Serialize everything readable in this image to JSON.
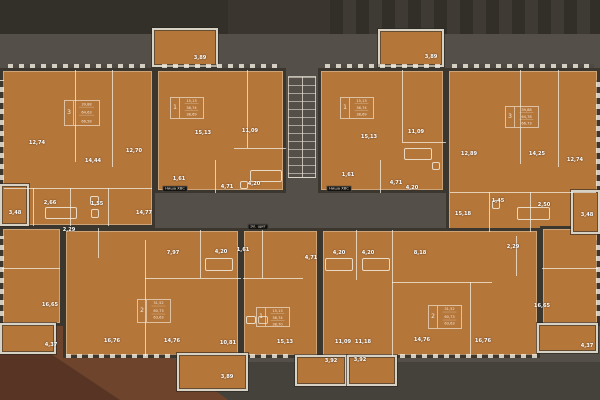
{
  "colors": {
    "apartment_fill": "#b5763a",
    "wall_dark": "#3b372f",
    "interior_line": "#f8f2e6",
    "background": "#544f48",
    "background_top": "#37332d",
    "background_bottom": "#45423c",
    "rust_triangle": "#6e452c",
    "rust_triangle_dark": "#573423",
    "balcony_frame": "#d8d2c4",
    "label_text": "#ffffff",
    "badge_bg": "#14120f"
  },
  "plan": {
    "apartments": [
      {
        "id": "top-left-outer",
        "x": 0,
        "y": 68,
        "w": 155,
        "h": 160
      },
      {
        "id": "top-left-inner",
        "x": 155,
        "y": 68,
        "w": 131,
        "h": 125
      },
      {
        "id": "top-right-inner",
        "x": 318,
        "y": 68,
        "w": 128,
        "h": 125
      },
      {
        "id": "top-right-outer",
        "x": 446,
        "y": 68,
        "w": 154,
        "h": 165
      },
      {
        "id": "bottom-left-outer",
        "x": 0,
        "y": 226,
        "w": 63,
        "h": 100
      },
      {
        "id": "bottom-left-inner",
        "x": 63,
        "y": 228,
        "w": 178,
        "h": 130
      },
      {
        "id": "bottom-center",
        "x": 241,
        "y": 228,
        "w": 79,
        "h": 130
      },
      {
        "id": "bottom-right-inner",
        "x": 320,
        "y": 228,
        "w": 220,
        "h": 130
      },
      {
        "id": "bottom-right-outer",
        "x": 540,
        "y": 226,
        "w": 60,
        "h": 100
      }
    ],
    "balconies": [
      {
        "id": "top-left-balcony",
        "x": 152,
        "y": 28,
        "w": 66,
        "h": 39
      },
      {
        "id": "top-right-balcony",
        "x": 378,
        "y": 29,
        "w": 66,
        "h": 38
      },
      {
        "id": "bottom-left-balcony",
        "x": 177,
        "y": 353,
        "w": 71,
        "h": 38
      },
      {
        "id": "bottom-center-balcony-1",
        "x": 295,
        "y": 355,
        "w": 52,
        "h": 31
      },
      {
        "id": "bottom-center-balcony-2",
        "x": 347,
        "y": 355,
        "w": 50,
        "h": 31
      },
      {
        "id": "left-side-balcony",
        "x": 0,
        "y": 323,
        "w": 56,
        "h": 31
      },
      {
        "id": "right-side-balcony",
        "x": 537,
        "y": 323,
        "w": 61,
        "h": 30
      },
      {
        "id": "left-loggia",
        "x": 0,
        "y": 184,
        "w": 29,
        "h": 42
      },
      {
        "id": "right-loggia",
        "x": 571,
        "y": 190,
        "w": 29,
        "h": 44
      }
    ],
    "rooms": [
      {
        "label": "12,74",
        "x": 37,
        "y": 143
      },
      {
        "label": "14,44",
        "x": 93,
        "y": 161
      },
      {
        "label": "12,70",
        "x": 134,
        "y": 151
      },
      {
        "label": "3,48",
        "x": 15,
        "y": 213
      },
      {
        "label": "2,66",
        "x": 50,
        "y": 203
      },
      {
        "label": "1,55",
        "x": 97,
        "y": 204
      },
      {
        "label": "14,77",
        "x": 144,
        "y": 213
      },
      {
        "label": "15,13",
        "x": 203,
        "y": 133
      },
      {
        "label": "11,09",
        "x": 250,
        "y": 131
      },
      {
        "label": "1,61",
        "x": 179,
        "y": 179
      },
      {
        "label": "4,71",
        "x": 227,
        "y": 187
      },
      {
        "label": "4,20",
        "x": 254,
        "y": 184
      },
      {
        "label": "15,13",
        "x": 369,
        "y": 137
      },
      {
        "label": "11,09",
        "x": 416,
        "y": 132
      },
      {
        "label": "1,61",
        "x": 348,
        "y": 175
      },
      {
        "label": "4,71",
        "x": 396,
        "y": 183
      },
      {
        "label": "4,20",
        "x": 412,
        "y": 188
      },
      {
        "label": "12,89",
        "x": 469,
        "y": 154
      },
      {
        "label": "14,25",
        "x": 537,
        "y": 154
      },
      {
        "label": "12,74",
        "x": 575,
        "y": 160
      },
      {
        "label": "15,18",
        "x": 463,
        "y": 214
      },
      {
        "label": "1,45",
        "x": 498,
        "y": 201
      },
      {
        "label": "2,50",
        "x": 544,
        "y": 205
      },
      {
        "label": "3,48",
        "x": 587,
        "y": 215
      },
      {
        "label": "16,65",
        "x": 50,
        "y": 305
      },
      {
        "label": "2,29",
        "x": 69,
        "y": 230
      },
      {
        "label": "7,97",
        "x": 173,
        "y": 253
      },
      {
        "label": "4,20",
        "x": 221,
        "y": 252
      },
      {
        "label": "16,76",
        "x": 112,
        "y": 341
      },
      {
        "label": "14,76",
        "x": 172,
        "y": 341
      },
      {
        "label": "10,81",
        "x": 228,
        "y": 343
      },
      {
        "label": "1,61",
        "x": 243,
        "y": 250
      },
      {
        "label": "4,71",
        "x": 311,
        "y": 258
      },
      {
        "label": "15,13",
        "x": 285,
        "y": 342
      },
      {
        "label": "4,20",
        "x": 339,
        "y": 253
      },
      {
        "label": "4,20",
        "x": 368,
        "y": 253
      },
      {
        "label": "8,18",
        "x": 420,
        "y": 253
      },
      {
        "label": "2,29",
        "x": 513,
        "y": 247
      },
      {
        "label": "11,09",
        "x": 343,
        "y": 342
      },
      {
        "label": "11,18",
        "x": 363,
        "y": 342
      },
      {
        "label": "14,76",
        "x": 422,
        "y": 340
      },
      {
        "label": "16,76",
        "x": 483,
        "y": 341
      },
      {
        "label": "16,65",
        "x": 542,
        "y": 306
      },
      {
        "label": "4,37",
        "x": 587,
        "y": 346
      },
      {
        "label": "4,37",
        "x": 51,
        "y": 345
      },
      {
        "label": "3,89",
        "x": 200,
        "y": 58
      },
      {
        "label": "3,89",
        "x": 431,
        "y": 57
      },
      {
        "label": "3,89",
        "x": 227,
        "y": 377
      },
      {
        "label": "3,92",
        "x": 331,
        "y": 361
      },
      {
        "label": "3,92",
        "x": 360,
        "y": 360
      }
    ],
    "stamps": [
      {
        "x": 64,
        "y": 100,
        "w": 36,
        "h": 26,
        "count": "3",
        "lines": [
          "39,88",
          "64,63",
          "66,58"
        ]
      },
      {
        "x": 170,
        "y": 97,
        "w": 34,
        "h": 22,
        "count": "1",
        "lines": [
          "15,13",
          "36,74",
          "38,69"
        ]
      },
      {
        "x": 340,
        "y": 97,
        "w": 34,
        "h": 22,
        "count": "1",
        "lines": [
          "15,13",
          "36,74",
          "38,69"
        ]
      },
      {
        "x": 505,
        "y": 106,
        "w": 34,
        "h": 22,
        "count": "3",
        "lines": [
          "39,88",
          "64,78",
          "66,73"
        ]
      },
      {
        "x": 137,
        "y": 299,
        "w": 34,
        "h": 24,
        "count": "2",
        "lines": [
          "31,52",
          "60,73",
          "63,63"
        ]
      },
      {
        "x": 256,
        "y": 307,
        "w": 34,
        "h": 20,
        "count": "1",
        "lines": [
          "15,13",
          "36,74",
          "38,70"
        ]
      },
      {
        "x": 428,
        "y": 305,
        "w": 34,
        "h": 24,
        "count": "2",
        "lines": [
          "31,52",
          "60,73",
          "63,63"
        ]
      }
    ],
    "badges": [
      {
        "label": "Ниша ХВС",
        "x": 175,
        "y": 189
      },
      {
        "label": "Ниша ХВС",
        "x": 339,
        "y": 189
      },
      {
        "label": "Эл. щит",
        "x": 258,
        "y": 227
      }
    ],
    "partitions": [
      {
        "x": 75,
        "y": 70,
        "w": 1,
        "h": 92
      },
      {
        "x": 112,
        "y": 70,
        "w": 1,
        "h": 97
      },
      {
        "x": 4,
        "y": 188,
        "w": 148,
        "h": 1
      },
      {
        "x": 33,
        "y": 188,
        "w": 1,
        "h": 38
      },
      {
        "x": 70,
        "y": 188,
        "w": 1,
        "h": 38
      },
      {
        "x": 108,
        "y": 188,
        "w": 1,
        "h": 38
      },
      {
        "x": 247,
        "y": 70,
        "w": 1,
        "h": 78
      },
      {
        "x": 234,
        "y": 148,
        "w": 52,
        "h": 1
      },
      {
        "x": 215,
        "y": 160,
        "w": 1,
        "h": 33
      },
      {
        "x": 402,
        "y": 70,
        "w": 1,
        "h": 72
      },
      {
        "x": 402,
        "y": 142,
        "w": 44,
        "h": 1
      },
      {
        "x": 380,
        "y": 160,
        "w": 1,
        "h": 33
      },
      {
        "x": 520,
        "y": 70,
        "w": 1,
        "h": 94
      },
      {
        "x": 558,
        "y": 70,
        "w": 1,
        "h": 97
      },
      {
        "x": 450,
        "y": 192,
        "w": 146,
        "h": 1
      },
      {
        "x": 489,
        "y": 192,
        "w": 1,
        "h": 40
      },
      {
        "x": 530,
        "y": 192,
        "w": 1,
        "h": 40
      },
      {
        "x": 2,
        "y": 268,
        "w": 58,
        "h": 1
      },
      {
        "x": 145,
        "y": 240,
        "w": 1,
        "h": 116
      },
      {
        "x": 200,
        "y": 230,
        "w": 1,
        "h": 48
      },
      {
        "x": 145,
        "y": 278,
        "w": 96,
        "h": 1
      },
      {
        "x": 98,
        "y": 228,
        "w": 1,
        "h": 30
      },
      {
        "x": 262,
        "y": 230,
        "w": 1,
        "h": 48
      },
      {
        "x": 243,
        "y": 278,
        "w": 60,
        "h": 1
      },
      {
        "x": 356,
        "y": 230,
        "w": 1,
        "h": 50
      },
      {
        "x": 392,
        "y": 230,
        "w": 1,
        "h": 126
      },
      {
        "x": 392,
        "y": 282,
        "w": 100,
        "h": 1
      },
      {
        "x": 470,
        "y": 282,
        "w": 1,
        "h": 74
      },
      {
        "x": 516,
        "y": 236,
        "w": 1,
        "h": 40
      },
      {
        "x": 542,
        "y": 268,
        "w": 56,
        "h": 1
      }
    ],
    "fixtures": [
      {
        "x": 45,
        "y": 207,
        "w": 32,
        "h": 12
      },
      {
        "x": 90,
        "y": 196,
        "w": 9,
        "h": 9
      },
      {
        "x": 91,
        "y": 209,
        "w": 8,
        "h": 9
      },
      {
        "x": 250,
        "y": 170,
        "w": 32,
        "h": 12
      },
      {
        "x": 240,
        "y": 181,
        "w": 8,
        "h": 8
      },
      {
        "x": 404,
        "y": 148,
        "w": 28,
        "h": 12
      },
      {
        "x": 432,
        "y": 162,
        "w": 8,
        "h": 8
      },
      {
        "x": 517,
        "y": 207,
        "w": 33,
        "h": 13
      },
      {
        "x": 492,
        "y": 200,
        "w": 8,
        "h": 9
      },
      {
        "x": 205,
        "y": 258,
        "w": 28,
        "h": 13
      },
      {
        "x": 246,
        "y": 316,
        "w": 10,
        "h": 8
      },
      {
        "x": 258,
        "y": 316,
        "w": 10,
        "h": 8
      },
      {
        "x": 325,
        "y": 258,
        "w": 28,
        "h": 13
      },
      {
        "x": 362,
        "y": 258,
        "w": 28,
        "h": 13
      }
    ],
    "hatches": [
      {
        "x": 8,
        "y": 64,
        "w": 140,
        "h": 4,
        "v": 0
      },
      {
        "x": 162,
        "y": 64,
        "w": 118,
        "h": 4,
        "v": 0
      },
      {
        "x": 325,
        "y": 64,
        "w": 115,
        "h": 4,
        "v": 0
      },
      {
        "x": 452,
        "y": 64,
        "w": 142,
        "h": 4,
        "v": 0
      },
      {
        "x": 66,
        "y": 354,
        "w": 110,
        "h": 4,
        "v": 0
      },
      {
        "x": 250,
        "y": 354,
        "w": 44,
        "h": 4,
        "v": 0
      },
      {
        "x": 400,
        "y": 354,
        "w": 138,
        "h": 4,
        "v": 0
      },
      {
        "x": 0,
        "y": 80,
        "w": 4,
        "h": 100,
        "v": 1
      },
      {
        "x": 596,
        "y": 80,
        "w": 4,
        "h": 106,
        "v": 1
      },
      {
        "x": 0,
        "y": 236,
        "w": 4,
        "h": 80,
        "v": 1
      },
      {
        "x": 596,
        "y": 240,
        "w": 4,
        "h": 76,
        "v": 1
      }
    ],
    "stairs": {
      "x": 288,
      "y": 76,
      "w": 28,
      "h": 102
    }
  }
}
